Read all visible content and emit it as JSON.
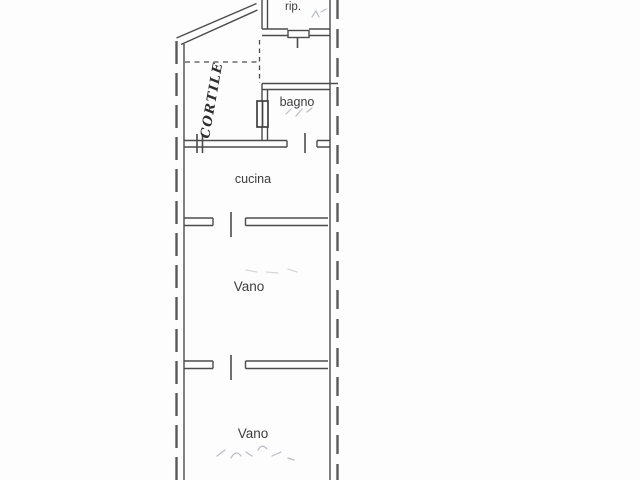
{
  "plan": {
    "rooms": [
      {
        "id": "rip",
        "label": "rip."
      },
      {
        "id": "bagno",
        "label": "bagno"
      },
      {
        "id": "cucina",
        "label": "cucina"
      },
      {
        "id": "vano-1",
        "label": "Vano"
      },
      {
        "id": "vano-2",
        "label": "Vano"
      },
      {
        "id": "cortile",
        "label": "CORTILE"
      }
    ],
    "colors": {
      "background": "#fdfdfd",
      "wall_line": "#4c4c4c",
      "label_text": "#3d3d3d",
      "handwriting": "#2e2e2e",
      "faint_pencil": "#b8bcc3"
    }
  }
}
